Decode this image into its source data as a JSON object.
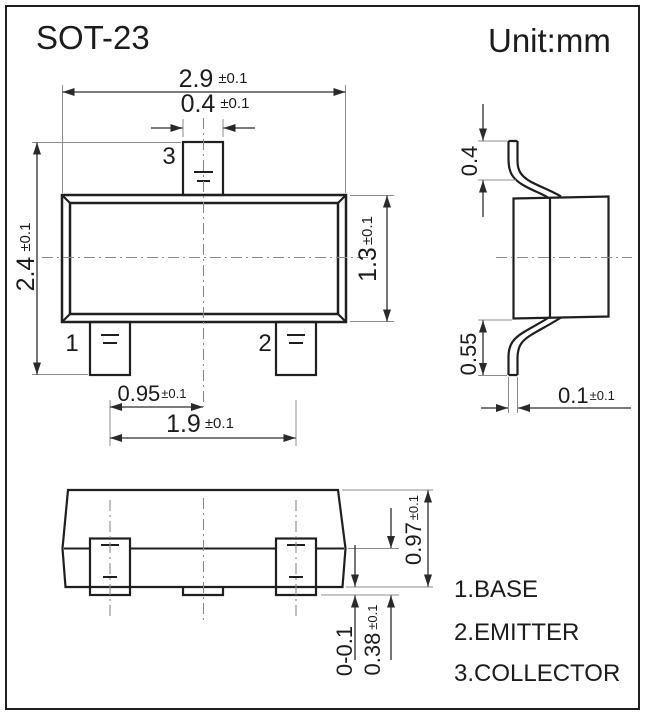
{
  "colors": {
    "ink": "#1a1a1a",
    "background": "#ffffff"
  },
  "title": "SOT-23",
  "unit_label": "Unit:mm",
  "front_view": {
    "pin1_label": "1",
    "pin2_label": "2",
    "pin3_label": "3",
    "dim_body_width": {
      "value": "2.9",
      "tol": "±0.1"
    },
    "dim_pin3_width": {
      "value": "0.4",
      "tol": "±0.1"
    },
    "dim_total_height": {
      "value": "2.4",
      "tol": "±0.1"
    },
    "dim_body_height": {
      "value": "1.3",
      "tol": "±0.1"
    },
    "dim_pin_pitch": {
      "value": "0.95",
      "tol": "±0.1"
    },
    "dim_pin_span": {
      "value": "1.9",
      "tol": "±0.1"
    }
  },
  "side_view": {
    "dim_shoulder_height": {
      "value": "0.4"
    },
    "dim_lead_height": {
      "value": "0.55"
    },
    "dim_lead_thickness": {
      "value": "0.1",
      "tol": "±0.1"
    }
  },
  "bottom_view": {
    "dim_body_thickness": {
      "value": "0.97",
      "tol": "±0.1"
    },
    "dim_standoff": {
      "value": "0-0.1"
    },
    "dim_foot_height": {
      "value": "0.38",
      "tol": "±0.1"
    }
  },
  "legend": {
    "items": [
      {
        "label": "1.BASE"
      },
      {
        "label": "2.EMITTER"
      },
      {
        "label": "3.COLLECTOR"
      }
    ]
  }
}
